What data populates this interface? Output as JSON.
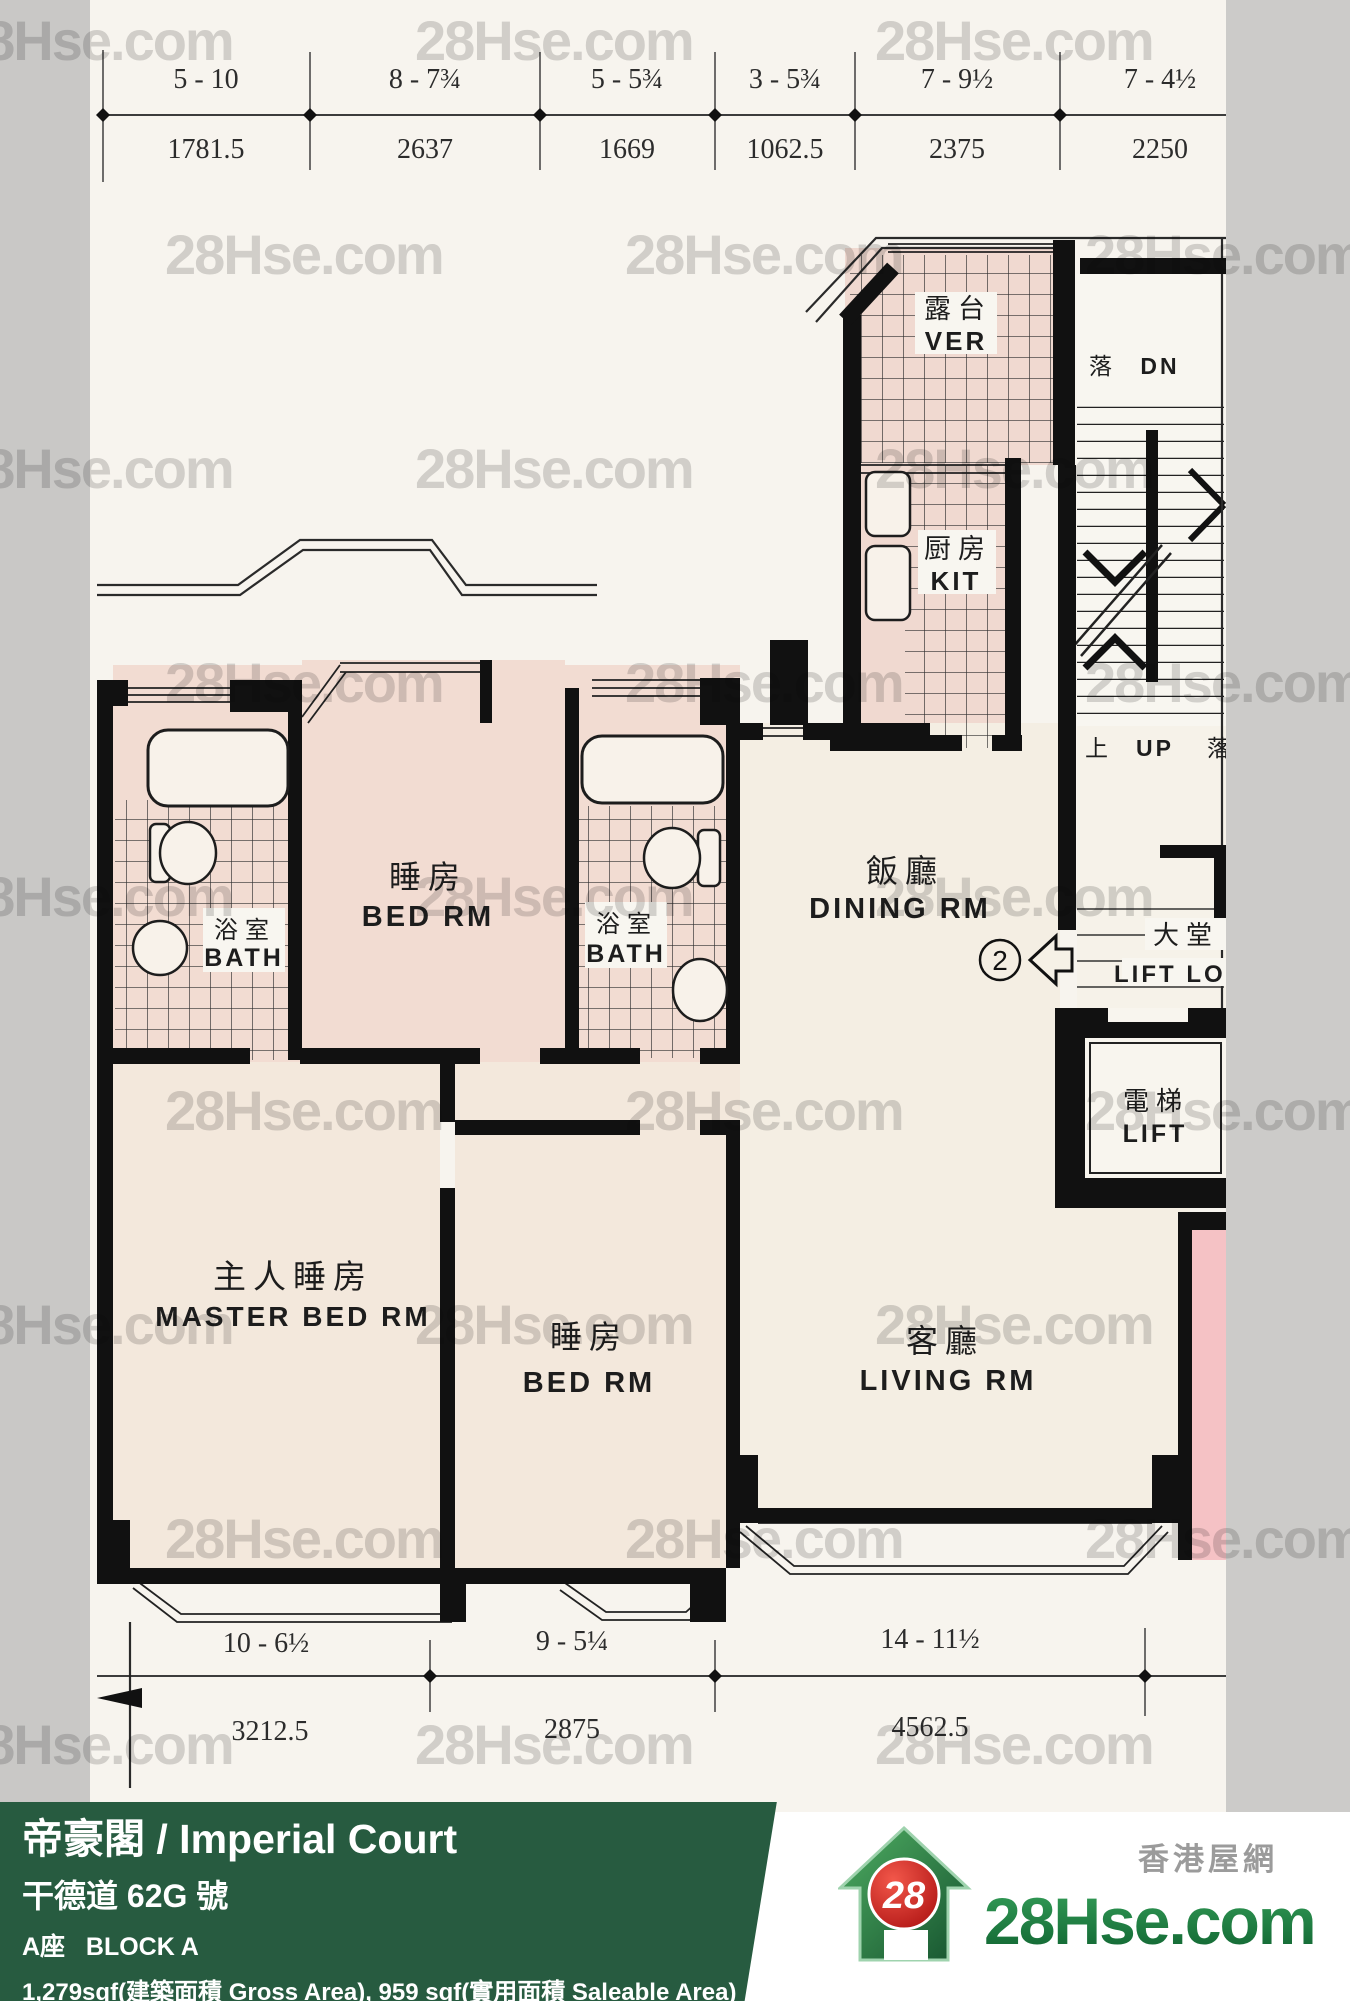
{
  "watermark": {
    "text": "28Hse.com"
  },
  "dimensions": {
    "top": {
      "feet": [
        "5 - 10",
        "8 - 7¾",
        "5 - 5¾",
        "3 - 5¾",
        "7 - 9½",
        "7 - 4½"
      ],
      "mm": [
        "1781.5",
        "2637",
        "1669",
        "1062.5",
        "2375",
        "2250"
      ]
    },
    "bottom": {
      "feet": [
        "10 - 6½",
        "9 - 5¼",
        "14 - 11½"
      ],
      "mm": [
        "3212.5",
        "2875",
        "4562.5"
      ]
    }
  },
  "rooms": {
    "verandah": {
      "zh": "露台",
      "en": "VER"
    },
    "kitchen": {
      "zh": "厨房",
      "en": "KIT"
    },
    "bedroom1": {
      "zh": "睡房",
      "en": "BED RM"
    },
    "bath1": {
      "zh": "浴室",
      "en": "BATH"
    },
    "bath2": {
      "zh": "浴室",
      "en": "BATH"
    },
    "dining": {
      "zh": "飯廳",
      "en": "DINING RM"
    },
    "lobby": {
      "zh": "大堂",
      "en": "LIFT LOB"
    },
    "lift": {
      "zh": "電梯",
      "en": "LIFT"
    },
    "master": {
      "zh": "主人睡房",
      "en": "MASTER BED RM"
    },
    "bedroom2": {
      "zh": "睡房",
      "en": "BED RM"
    },
    "living": {
      "zh": "客廳",
      "en": "LIVING RM"
    }
  },
  "stairs": {
    "down_zh": "落",
    "down_en": "DN",
    "up_zh": "上",
    "up_en": "UP",
    "down2_zh": "落"
  },
  "unit_marker": {
    "number": "2"
  },
  "footer": {
    "title": "帝豪閣 / Imperial Court",
    "address": "干德道 62G 號",
    "block": "A座   BLOCK A",
    "area": "1,279sqf(建築面積 Gross Area), 959 sqf(實用面積 Saleable Area)"
  },
  "logo": {
    "badge": "28",
    "name": "28Hse.com",
    "tagline": "香港屋網"
  },
  "colors": {
    "accent_green": "#275b40",
    "logo_green": "#1e7b41",
    "badge_red": "#cc1f1a",
    "room_pink": "#f2dcd2",
    "neighbor_pink": "#f5c2c5"
  }
}
